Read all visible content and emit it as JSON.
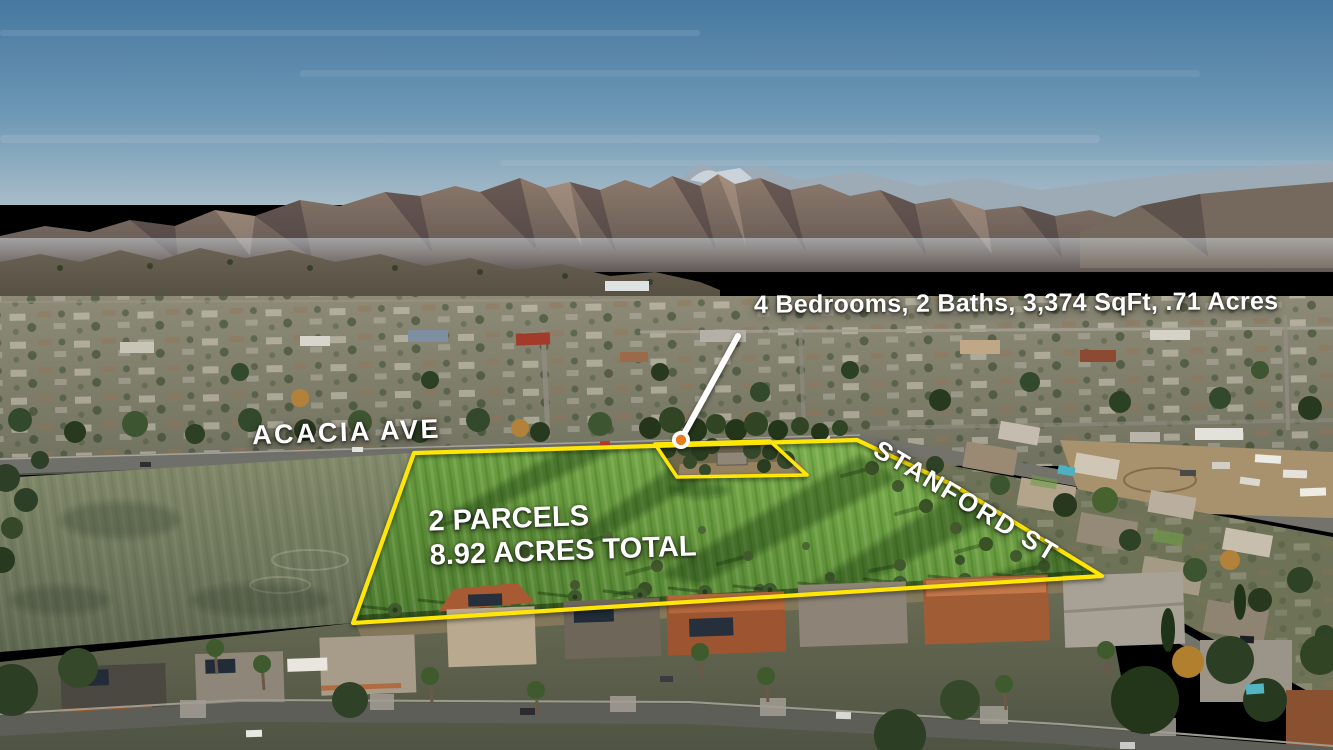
{
  "annotations": {
    "property_details": "4 Bedrooms, 2 Baths, 3,374 SqFt, .71 Acres",
    "street_label_acacia": "ACACIA AVE",
    "street_label_stanford": "STANFORD ST",
    "parcel_summary_line1": "2 PARCELS",
    "parcel_summary_line2": "8.92 ACRES TOTAL"
  },
  "colors": {
    "boundary_yellow": "#ffe606",
    "callout_white": "#ffffff",
    "marker_orange": "#e87d1f"
  }
}
